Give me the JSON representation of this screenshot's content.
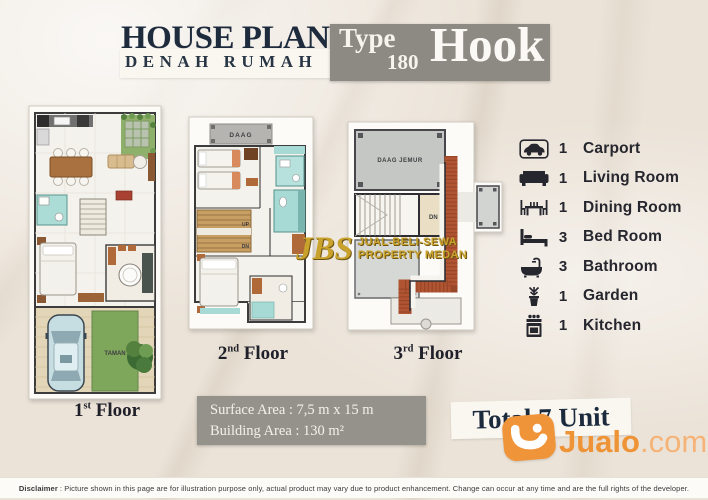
{
  "header": {
    "title": "HOUSE PLAN",
    "subtitle": "DENAH RUMAH",
    "type_label": "Type",
    "type_number": "180",
    "type_name": "Hook"
  },
  "plans": [
    {
      "num": "1",
      "sup": "st",
      "word": "Floor",
      "taman": "TAMAN"
    },
    {
      "num": "2",
      "sup": "nd",
      "word": "Floor",
      "daag": "DAAG",
      "up": "UP",
      "dn": "DN"
    },
    {
      "num": "3",
      "sup": "rd",
      "word": "Floor",
      "daag_jemur": "DAAG JEMUR",
      "dn": "DN"
    }
  ],
  "legend": {
    "items": [
      {
        "icon": "car-icon",
        "count": "1",
        "label": "Carport"
      },
      {
        "icon": "sofa-icon",
        "count": "1",
        "label": "Living Room"
      },
      {
        "icon": "dining-table-icon",
        "count": "1",
        "label": "Dining Room"
      },
      {
        "icon": "bed-icon",
        "count": "3",
        "label": "Bed Room"
      },
      {
        "icon": "bathtub-icon",
        "count": "3",
        "label": "Bathroom"
      },
      {
        "icon": "plant-icon",
        "count": "1",
        "label": "Garden"
      },
      {
        "icon": "stove-icon",
        "count": "1",
        "label": "Kitchen"
      }
    ]
  },
  "area_box": {
    "surface_line": "Surface Area : 7,5 m x 15 m",
    "building_line": "Building Area : 130 m²"
  },
  "total_label": "Total 7 Unit",
  "watermark": {
    "initials": "JBS",
    "line1": "JUAL-BELI-SEWA",
    "line2": "PROPERTY MEDAN"
  },
  "brand": {
    "name": "Jualo",
    "tld": ".com"
  },
  "disclaimer": {
    "label": "Disclaimer",
    "text": ": Picture shown in this page are for illustration purpose only, actual product may vary due to product enhancement. Change can occur at any time and are the full rights of the developer."
  },
  "colors": {
    "navy": "#1d2b3d",
    "box_gray": "#8d8a83",
    "gold": "#c9a22c",
    "orange": "#f0943a",
    "teal": "#aadcd6",
    "roof": "#b15432",
    "garden_green": "#7fa75c"
  }
}
